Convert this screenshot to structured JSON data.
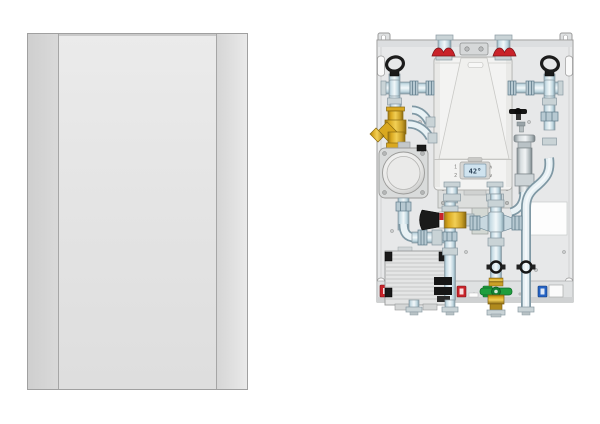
{
  "page": {
    "background": "#ffffff"
  },
  "figures": {
    "cover": {
      "label": "front-cover-panel"
    },
    "unit": {
      "label": "heat-interface-unit-assembly",
      "display": {
        "screen_value": "42°",
        "button_top_left": "1",
        "button_bottom_left": "2",
        "button_top_right": "∧",
        "button_bottom_right": "∨"
      },
      "colors": {
        "red_valve": "#c9232a",
        "yellow_strainer": "#e0ac22",
        "green_valve": "#1f9e3d",
        "brass": "#caa027",
        "pipe": "#dce9ee",
        "backplate": "#e7e8e9",
        "boiler": "#f3f3f2",
        "lcd": "#cfe3ef"
      },
      "port_labels": [
        {
          "name": "port-label-edge-red",
          "color": "#c9232a"
        },
        {
          "name": "port-label-red",
          "color": "#c9232a"
        },
        {
          "name": "port-label-green",
          "color": "#1f9e3d"
        },
        {
          "name": "port-label-blue",
          "color": "#2563c4"
        }
      ]
    }
  }
}
